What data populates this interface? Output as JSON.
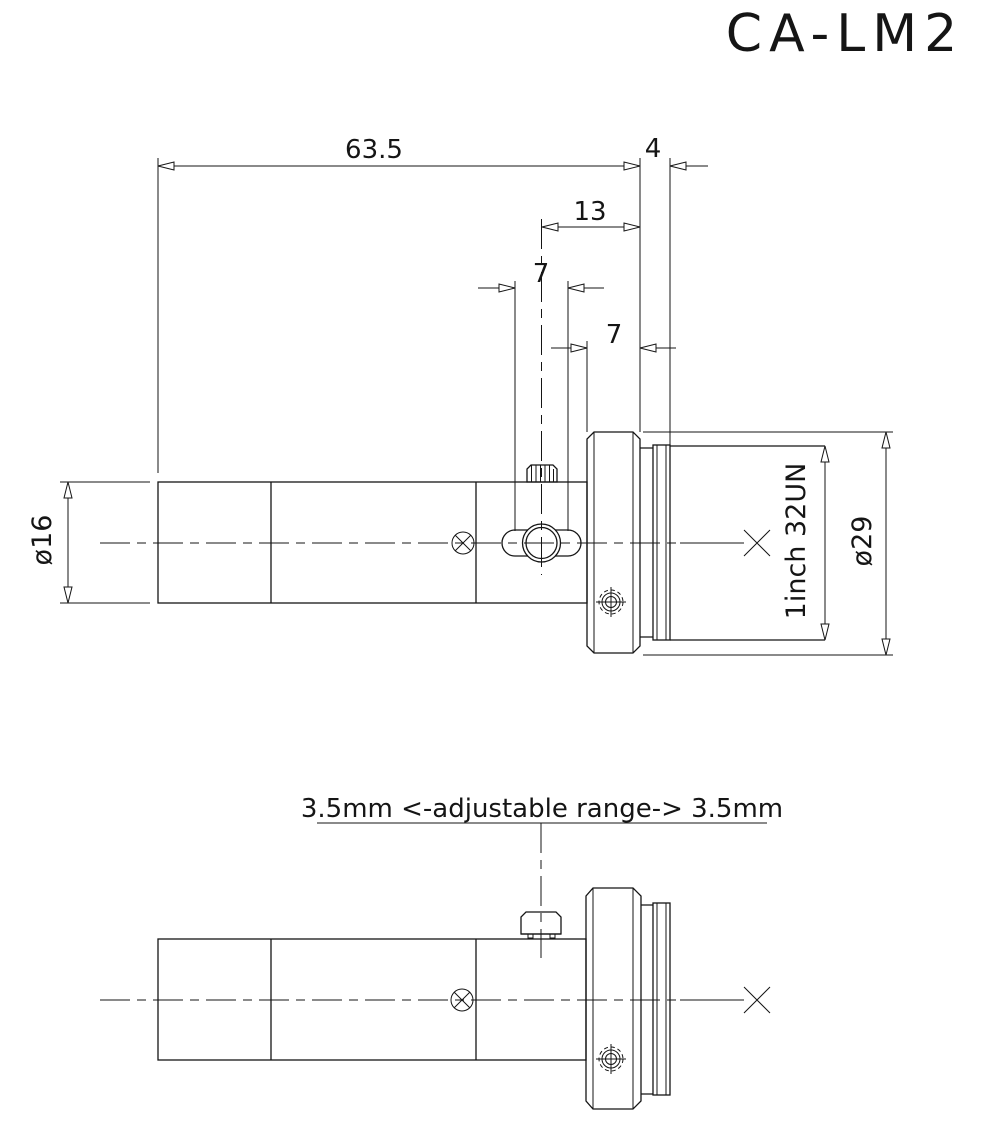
{
  "title": "CA-LM2",
  "colors": {
    "line": "#151515",
    "background": "#ffffff"
  },
  "top_view": {
    "dim_overall_length": "63.5",
    "dim_flange_to_thread": "4",
    "dim_knob_to_flange": "13",
    "dim_knob_travel": "7",
    "dim_flange_thickness": "7",
    "dim_tube_diameter": "ø16",
    "dim_flange_diameter": "ø29",
    "thread_spec": "1inch  32UN"
  },
  "bottom_view": {
    "adjustable_range_note": "3.5mm <-adjustable range-> 3.5mm"
  }
}
